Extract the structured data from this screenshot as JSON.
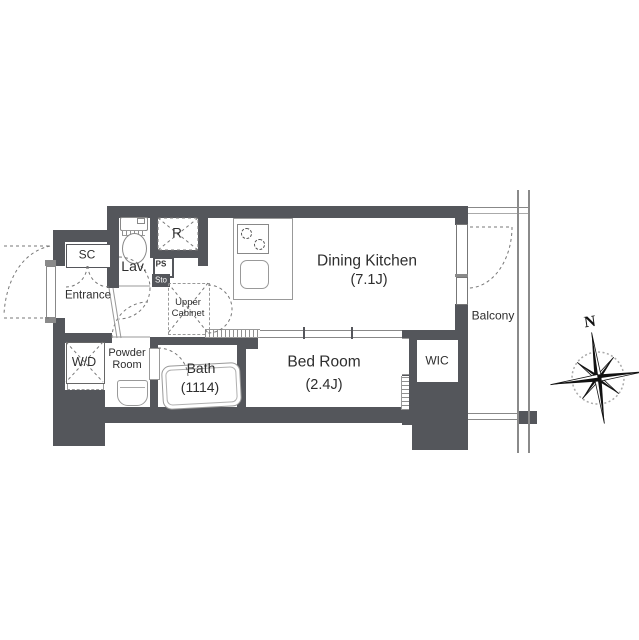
{
  "plan": {
    "title": "apartment-floor-plan",
    "rooms": {
      "shoe_closet": {
        "label": "SC"
      },
      "entrance": {
        "label": "Entrance"
      },
      "lavatory": {
        "label": "Lav."
      },
      "refrigerator": {
        "label": "R"
      },
      "pipe_space": {
        "label": "PS"
      },
      "storage": {
        "label": "Sto"
      },
      "upper_cabinet": {
        "label": "Upper Cabinet"
      },
      "washer_dryer": {
        "label": "W/D"
      },
      "powder_room": {
        "label": "Powder Room"
      },
      "bath": {
        "label": "Bath",
        "size": "(1114)"
      },
      "bed_room": {
        "label": "Bed Room",
        "size": "(2.4J)"
      },
      "dining_kitchen": {
        "label": "Dining Kitchen",
        "size": "(7.1J)"
      },
      "wic": {
        "label": "WIC"
      },
      "balcony": {
        "label": "Balcony"
      }
    },
    "compass": {
      "north_label": "N"
    },
    "colors": {
      "wall": "#54565b",
      "thin_line": "#8a8a8a",
      "dashed_line": "#777777",
      "text": "#2e2e2e",
      "background": "#ffffff"
    }
  }
}
